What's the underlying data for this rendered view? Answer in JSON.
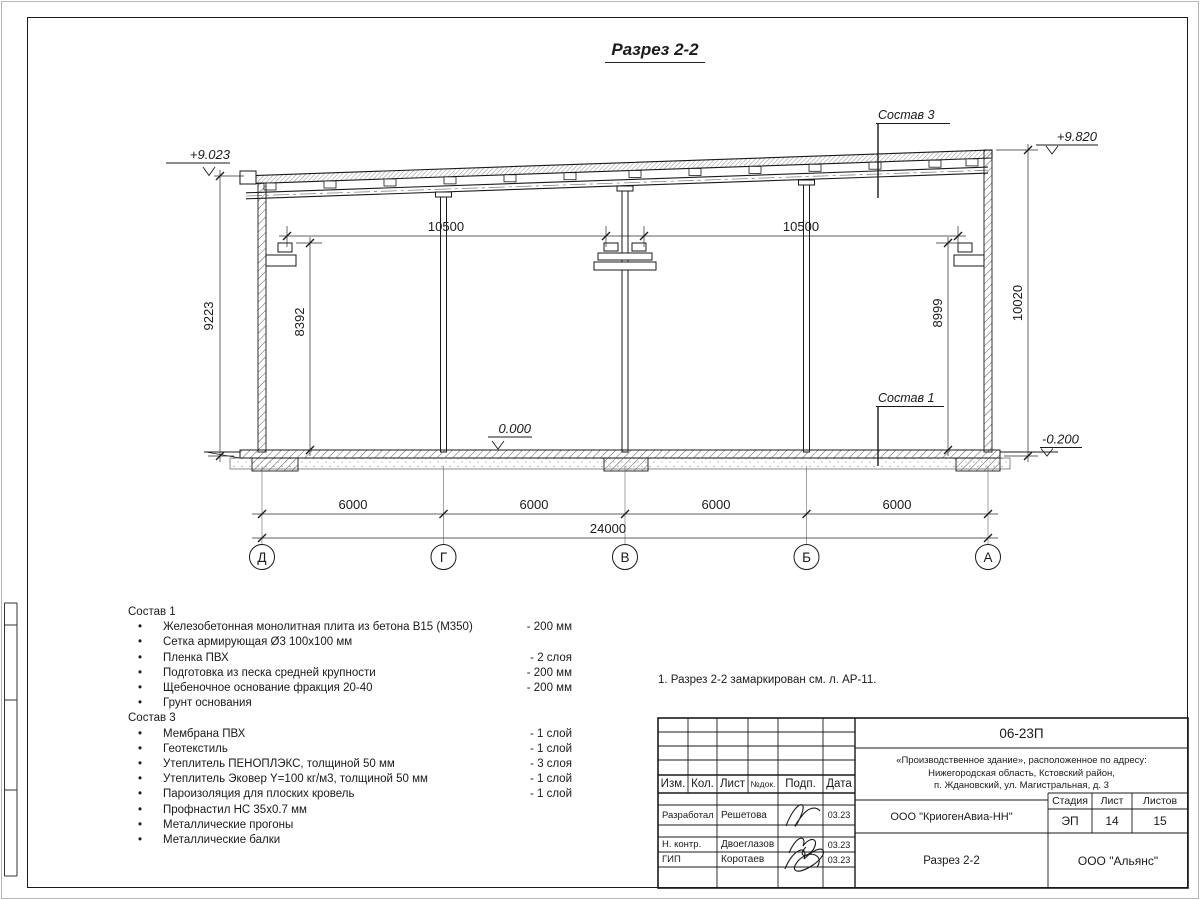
{
  "sheet": {
    "title": "Разрез 2-2",
    "note": "1. Разрез 2-2 замаркирован см. л. АР-11."
  },
  "drawing": {
    "elevations": {
      "roof_left": "+9.023",
      "roof_right": "+9.820",
      "floor": "0.000",
      "ground": "-0.200"
    },
    "dims": {
      "crane_span_1": "10500",
      "crane_span_2": "10500",
      "height_left": "9223",
      "height_crane_left": "8392",
      "height_crane_right": "8999",
      "height_right": "10020",
      "bays": [
        "6000",
        "6000",
        "6000",
        "6000"
      ],
      "total": "24000"
    },
    "axes": [
      "Д",
      "Г",
      "В",
      "Б",
      "А"
    ],
    "callouts": {
      "sostav3": "Состав 3",
      "sostav1": "Состав 1"
    }
  },
  "legend": {
    "sostav1": {
      "title": "Состав 1",
      "items": [
        {
          "text": "Железобетонная монолитная плита из бетона В15 (М350)",
          "value": "-  200 мм"
        },
        {
          "text": "Сетка армирующая Ø3 100х100 мм",
          "value": ""
        },
        {
          "text": "Пленка ПВХ",
          "value": "-  2 слоя"
        },
        {
          "text": "Подготовка из песка средней крупности",
          "value": "- 200 мм"
        },
        {
          "text": "Щебеночное основание фракция 20-40",
          "value": "- 200 мм"
        },
        {
          "text": "Грунт основания",
          "value": ""
        }
      ]
    },
    "sostav3": {
      "title": "Состав 3",
      "items": [
        {
          "text": "Мембрана ПВХ",
          "value": "- 1 слой"
        },
        {
          "text": "Геотекстиль",
          "value": "- 1 слой"
        },
        {
          "text": "Утеплитель ПЕНОПЛЭКС, толщиной 50 мм",
          "value": "- 3 слоя"
        },
        {
          "text": "Утеплитель Эковер Y=100 кг/м3, толщиной 50 мм",
          "value": "- 1 слой"
        },
        {
          "text": "Пароизоляция для плоских кровель",
          "value": "- 1 слой"
        },
        {
          "text": "Профнастил НС 35х0.7 мм",
          "value": ""
        },
        {
          "text": "Металлические прогоны",
          "value": ""
        },
        {
          "text": "Металлические балки",
          "value": ""
        }
      ]
    }
  },
  "titleblock": {
    "doc_number": "06-23П",
    "address_lines": [
      "«Производственное здание», расположенное по адресу:",
      "Нижегородская область, Кстовский район,",
      "п. Ждановский, ул. Магистральная, д. 3"
    ],
    "columns": {
      "izm": "Изм.",
      "kol": "Кол.",
      "list": "Лист",
      "ndok": "№док.",
      "podp": "Подп.",
      "data": "Дата"
    },
    "rows": [
      {
        "role": "Разработал",
        "name": "Решетова",
        "date": "03.23"
      },
      {
        "role": "Н. контр.",
        "name": "Двоеглазов",
        "date": "03.23"
      },
      {
        "role": "ГИП",
        "name": "Коротаев",
        "date": "03.23"
      }
    ],
    "company": "ООО \"КриогенАвиа-НН\"",
    "drawing_title": "Разрез 2-2",
    "contractor": "ООО \"Альянс\"",
    "stage_label": "Стадия",
    "sheet_label": "Лист",
    "sheets_label": "Листов",
    "stage": "ЭП",
    "sheet_no": "14",
    "sheets_total": "15"
  }
}
